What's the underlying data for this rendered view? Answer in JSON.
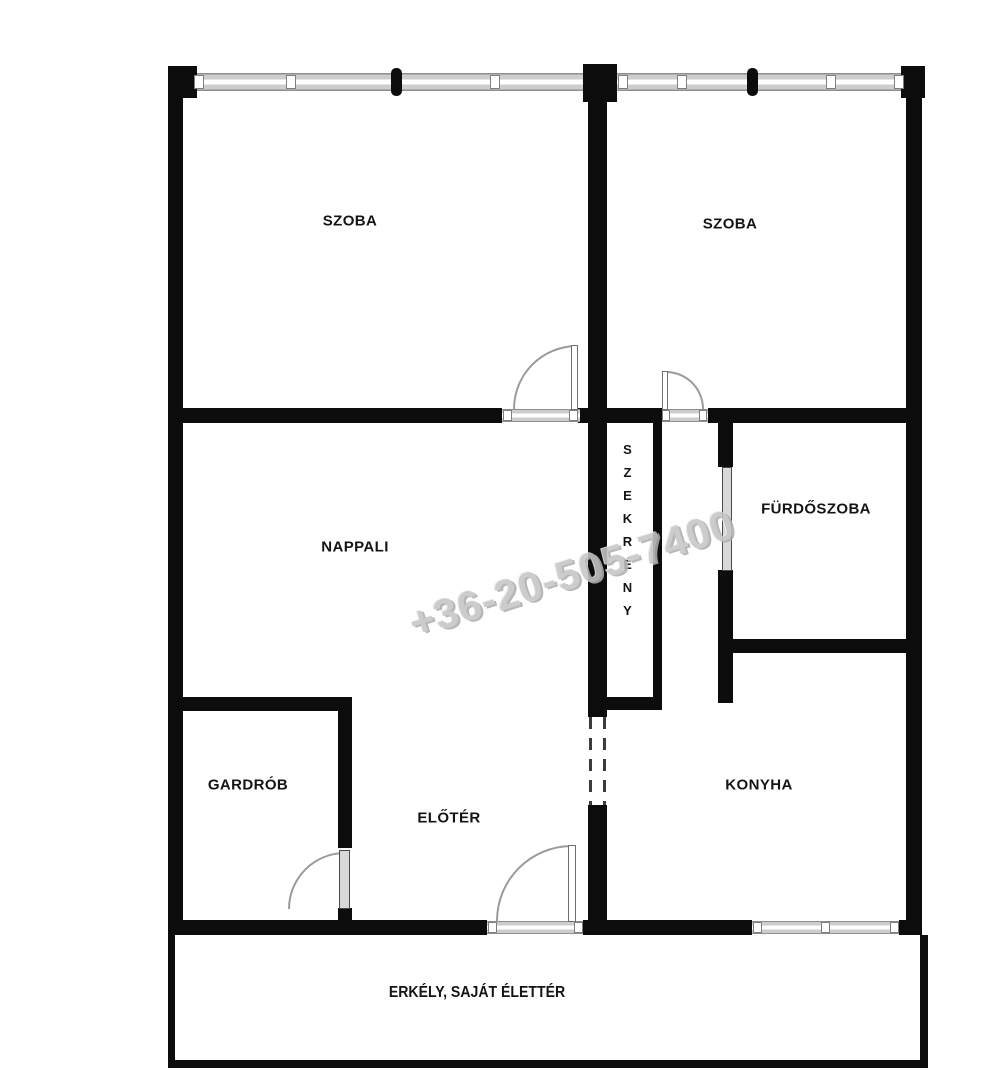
{
  "watermark": {
    "text": "+36-20-505-7400"
  },
  "rooms": {
    "szoba_left": {
      "label": "SZOBA"
    },
    "szoba_right": {
      "label": "SZOBA"
    },
    "nappali": {
      "label": "NAPPALI"
    },
    "szekreny": {
      "label": "SZEKRÉNY"
    },
    "furdoszoba": {
      "label": "FÜRDŐSZOBA"
    },
    "gardrob": {
      "label": "GARDRÓB"
    },
    "eloter": {
      "label": "ELŐTÉR"
    },
    "konyha": {
      "label": "KONYHA"
    },
    "erkely": {
      "label": "ERKÉLY, SAJÁT ÉLETTÉR"
    }
  },
  "colors": {
    "wall": "#0c0c0c",
    "window_fill": "#cdcdcd",
    "door_arc": "#9b9b9b",
    "watermark": "#c6c6c6"
  }
}
